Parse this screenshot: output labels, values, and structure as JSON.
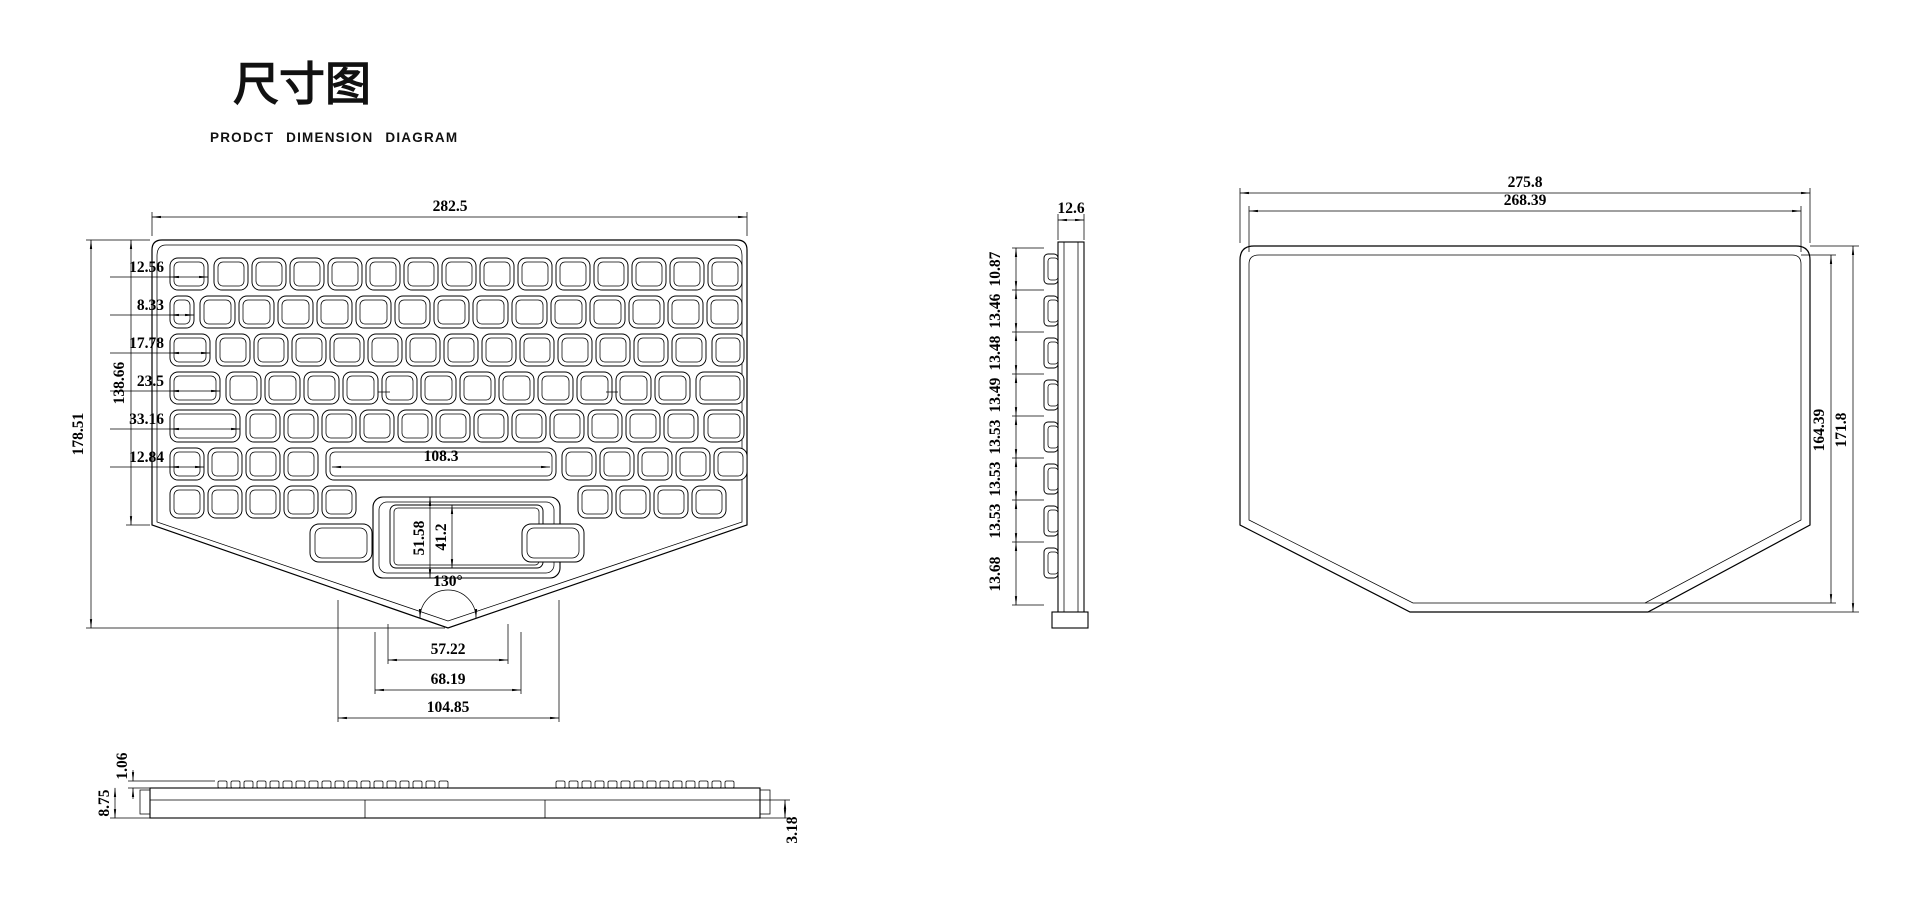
{
  "title": {
    "main": "尺寸图",
    "subtitle": "PRODCT DIMENSION DIAGRAM"
  },
  "front": {
    "width": "282.5",
    "total_height": "178.51",
    "key_area_height": "138.66",
    "key_widths": [
      "12.56",
      "8.33",
      "17.78",
      "23.5",
      "33.16",
      "12.84"
    ],
    "spacebar_width": "108.3",
    "touchpad_outer_height": "51.58",
    "touchpad_inner_height": "41.2",
    "notch_angle": "130°",
    "notch_width_inner": "57.22",
    "notch_width_mid": "68.19",
    "notch_width_outer": "104.85"
  },
  "side": {
    "thickness": "12.6",
    "row_pitches": [
      "10.87",
      "13.46",
      "13.48",
      "13.49",
      "13.53",
      "13.53",
      "13.53",
      "13.68"
    ]
  },
  "back": {
    "outer_width": "275.8",
    "inner_width": "268.39",
    "inner_height": "164.39",
    "outer_height": "171.8"
  },
  "bottom": {
    "keycap_height": "1.06",
    "total_thickness": "8.75",
    "base_thickness": "3.18"
  }
}
